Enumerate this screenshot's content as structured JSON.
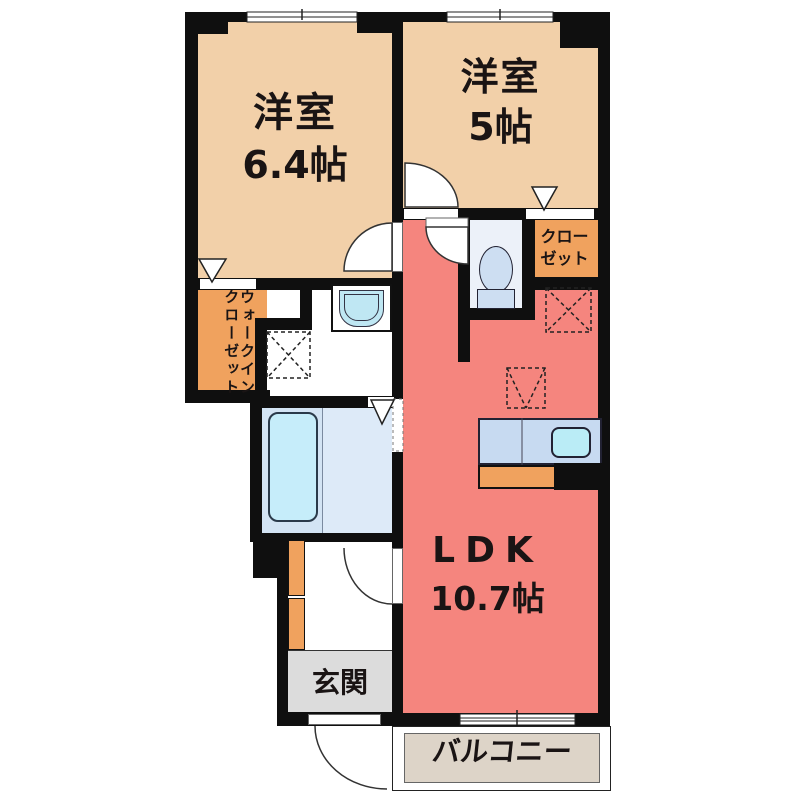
{
  "plan": {
    "title": "1LDK apartment floor plan",
    "rooms": {
      "bedroom1": {
        "name": "洋室",
        "size": "6.4帖"
      },
      "bedroom2": {
        "name": "洋室",
        "size": "5帖"
      },
      "ldk": {
        "name": "LDK",
        "size": "10.7帖"
      },
      "closet": {
        "line1": "クロー",
        "line2": "ゼット"
      },
      "walk_in_closet": {
        "line1": "ウォークイン",
        "line2": "クローゼット"
      },
      "entrance": {
        "name": "玄関"
      },
      "balcony": {
        "name": "バルコニー"
      }
    },
    "colors": {
      "wall": "#0f0f0f",
      "room": "#f2d0a9",
      "orange": "#f0a25e",
      "salmon": "#f5857e",
      "bath": "#d3e4f4",
      "bath_light": "#ddeaf8",
      "tub": "#c6edfa",
      "fixture": "#cddef2",
      "toilet_room": "#ecf1f9",
      "counter": "#c7daf1",
      "sink": "#baecf6",
      "genkan": "#dcdcdc",
      "balcony_floor": "#ddd4c8",
      "text": "#1a1414"
    }
  }
}
